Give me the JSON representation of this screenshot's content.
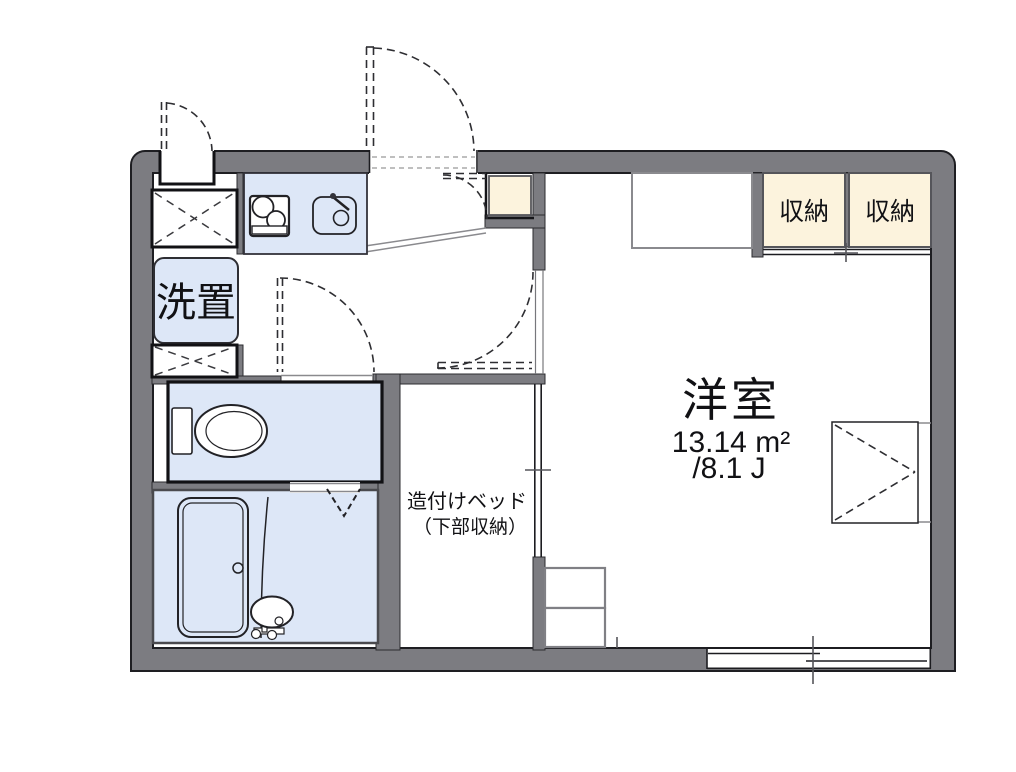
{
  "plan_type": "apartment-floor-plan",
  "colors": {
    "wall": "#7c7c81",
    "water_area": "#dde7f7",
    "storage": "#fcf3dd",
    "line": "#1e1e22"
  },
  "rooms": {
    "main_room": {
      "name": "洋室",
      "area_sqm": "13.14 m²",
      "area_tatami": "/8.1 J"
    },
    "bed": {
      "line1": "造付けベッド",
      "line2": "（下部収納）"
    },
    "laundry": {
      "label": "洗置"
    },
    "closets": [
      {
        "label": "収納"
      },
      {
        "label": "収納"
      }
    ]
  }
}
